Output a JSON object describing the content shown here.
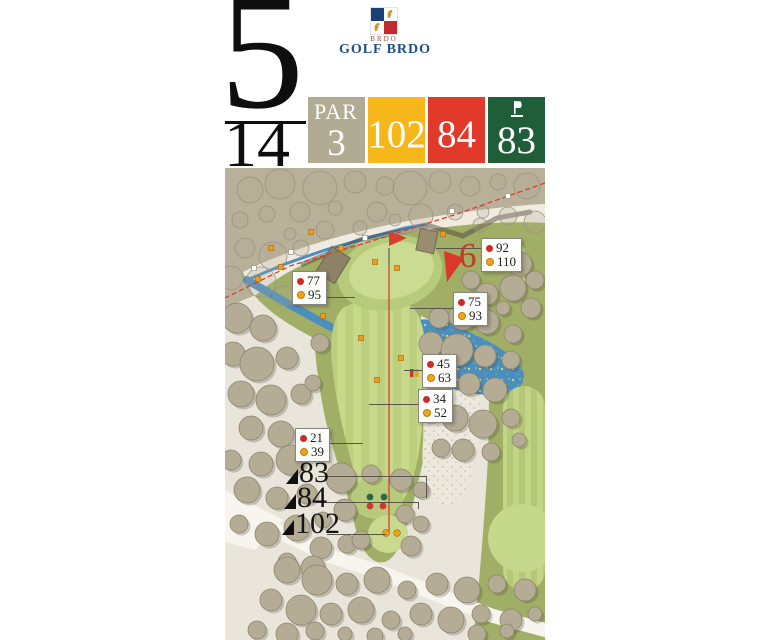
{
  "header": {
    "hole_number": "5",
    "hole_index": "14"
  },
  "logo": {
    "abbr": "BRDO",
    "club_name": "GOLF BRDO"
  },
  "score_boxes": {
    "par": {
      "label": "PAR",
      "value": "3",
      "bg": "#b2ab93"
    },
    "yellow": {
      "value": "102",
      "bg": "#f7b71a"
    },
    "red": {
      "value": "84",
      "bg": "#e23a2a"
    },
    "green": {
      "value": "83",
      "bg": "#1f5e39"
    }
  },
  "map": {
    "next_hole_label": "6",
    "distance_markers": [
      {
        "red": "92",
        "yellow": "110"
      },
      {
        "red": "77",
        "yellow": "95"
      },
      {
        "red": "75",
        "yellow": "93"
      },
      {
        "red": "45",
        "yellow": "63"
      },
      {
        "red": "34",
        "yellow": "52"
      },
      {
        "red": "21",
        "yellow": "39"
      }
    ],
    "tee_distance_labels": [
      "83",
      "84",
      "102"
    ]
  },
  "colors": {
    "red_dot": "#cf2b22",
    "yellow_dot": "#f2a51b",
    "accent_red": "#d5402f",
    "water": "#4a8fc0",
    "rough_green": "#a0ae66",
    "khaki": "#b8b099"
  }
}
